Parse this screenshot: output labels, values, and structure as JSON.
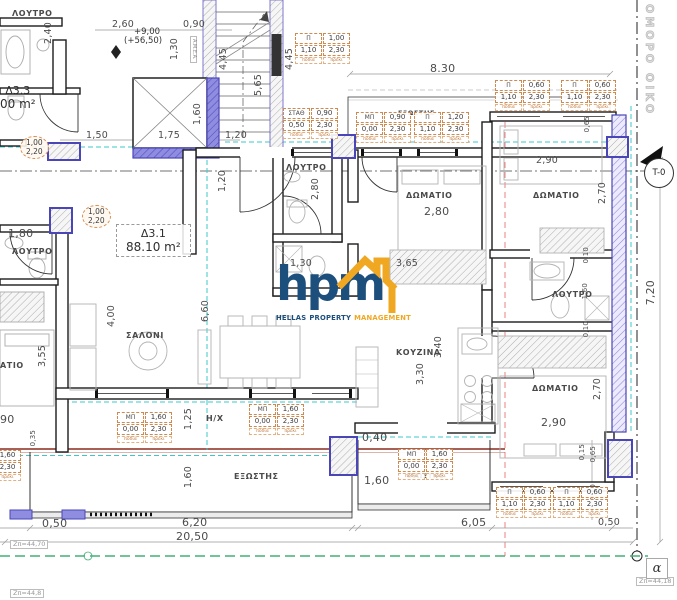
{
  "logo": {
    "word": "hpm",
    "tagline": [
      {
        "t": "HELLAS",
        "c": "navy"
      },
      {
        "t": "PROPERTY",
        "c": "navy"
      },
      {
        "t": "MANAGEMENT",
        "c": "orange"
      }
    ],
    "navy": "#1c4f7c",
    "orange": "#f0a722"
  },
  "apartments": [
    {
      "id": "Δ3.1",
      "area": "88.10 m²",
      "x": 116,
      "y": 224,
      "boxed": true
    },
    {
      "id": "Δ3.3",
      "area": "00 m²",
      "x": 0,
      "y": 84,
      "boxed": false
    }
  ],
  "rooms": [
    {
      "t": "ΛΟΥΤΡΟ",
      "x": 12,
      "y": 10
    },
    {
      "t": "ΛΟΥΤΡΟ",
      "x": 12,
      "y": 248
    },
    {
      "t": "ΑΤΙΟ",
      "x": 0,
      "y": 362
    },
    {
      "t": "ΣΑΛΟΝΙ",
      "x": 126,
      "y": 332
    },
    {
      "t": "ΛΟΥΤΡΟ",
      "x": 286,
      "y": 164
    },
    {
      "t": "ΔΩΜΑΤΙΟ",
      "x": 406,
      "y": 192
    },
    {
      "t": "ΚΟΥΖΙΝΑ",
      "x": 396,
      "y": 349
    },
    {
      "t": "ΔΩΜΑΤΙΟ",
      "x": 533,
      "y": 192
    },
    {
      "t": "ΛΟΥΤΡΟ",
      "x": 552,
      "y": 291
    },
    {
      "t": "ΔΩΜΑΤΙΟ",
      "x": 532,
      "y": 385
    },
    {
      "t": "ΕΞΩΣΤΗΣ",
      "x": 398,
      "y": 110,
      "sm": 1
    },
    {
      "t": "ΕΞΩΣΤΗΣ",
      "x": 234,
      "y": 473
    },
    {
      "t": "ΕΞΩΣΤΗΣ",
      "x": 407,
      "y": 473,
      "sm": 1
    },
    {
      "t": "Η/Χ",
      "x": 206,
      "y": 415
    }
  ],
  "dims": [
    {
      "t": "2,60",
      "x": 112,
      "y": 20
    },
    {
      "t": "0,90",
      "x": 183,
      "y": 20
    },
    {
      "t": "1,30",
      "x": 170,
      "y": 38,
      "v": 1
    },
    {
      "t": "2,40",
      "x": 44,
      "y": 22,
      "v": 1
    },
    {
      "t": "4,45",
      "x": 219,
      "y": 48,
      "v": 1
    },
    {
      "t": "4,45",
      "x": 285,
      "y": 48,
      "v": 1
    },
    {
      "t": "5,65",
      "x": 254,
      "y": 74,
      "v": 1
    },
    {
      "t": "1,60",
      "x": 193,
      "y": 103,
      "v": 1
    },
    {
      "t": "1,50",
      "x": 86,
      "y": 131
    },
    {
      "t": "1,75",
      "x": 158,
      "y": 131
    },
    {
      "t": "1,20",
      "x": 225,
      "y": 131
    },
    {
      "t": "8.30",
      "x": 430,
      "y": 63,
      "bg": 1
    },
    {
      "t": "0,65",
      "x": 584,
      "y": 116,
      "v": 1,
      "sm": 1
    },
    {
      "t": "2,90",
      "x": 536,
      "y": 156
    },
    {
      "t": "2,70",
      "x": 598,
      "y": 182,
      "v": 1
    },
    {
      "t": "7,20",
      "x": 645,
      "y": 280,
      "v": 1,
      "bg": 1
    },
    {
      "t": "2,80",
      "x": 311,
      "y": 178,
      "v": 1
    },
    {
      "t": "2,80",
      "x": 424,
      "y": 206,
      "bg": 1
    },
    {
      "t": "1,30",
      "x": 290,
      "y": 259
    },
    {
      "t": "3,65",
      "x": 396,
      "y": 259
    },
    {
      "t": "1,80",
      "x": 8,
      "y": 228,
      "bg": 1
    },
    {
      "t": "1,20",
      "x": 218,
      "y": 170,
      "v": 1
    },
    {
      "t": "4,00",
      "x": 107,
      "y": 305,
      "v": 1
    },
    {
      "t": "6,60",
      "x": 201,
      "y": 300,
      "v": 1
    },
    {
      "t": "3,55",
      "x": 38,
      "y": 345,
      "v": 1
    },
    {
      "t": "3,40",
      "x": 434,
      "y": 336,
      "v": 1
    },
    {
      "t": "3,30",
      "x": 416,
      "y": 363,
      "v": 1
    },
    {
      "t": "90",
      "x": 0,
      "y": 414,
      "bg": 1
    },
    {
      "t": "0,35",
      "x": 30,
      "y": 430,
      "v": 1,
      "sm": 1
    },
    {
      "t": "1,25",
      "x": 184,
      "y": 408,
      "v": 1
    },
    {
      "t": "1,60",
      "x": 184,
      "y": 466,
      "v": 1
    },
    {
      "t": "1,60",
      "x": 582,
      "y": 283,
      "v": 1,
      "sm": 1
    },
    {
      "t": "0,10",
      "x": 583,
      "y": 247,
      "v": 1,
      "sm": 1
    },
    {
      "t": "0,10",
      "x": 583,
      "y": 321,
      "v": 1,
      "sm": 1
    },
    {
      "t": "2,70",
      "x": 593,
      "y": 378,
      "v": 1
    },
    {
      "t": "2,90",
      "x": 541,
      "y": 417,
      "bg": 1
    },
    {
      "t": "0,40",
      "x": 362,
      "y": 432,
      "bg": 1
    },
    {
      "t": "1,60",
      "x": 364,
      "y": 475,
      "bg": 1
    },
    {
      "t": "0,15",
      "x": 579,
      "y": 444,
      "v": 1,
      "sm": 1
    },
    {
      "t": "0,65",
      "x": 590,
      "y": 446,
      "v": 1,
      "sm": 1
    },
    {
      "t": "0,70",
      "x": 590,
      "y": 484,
      "v": 1,
      "sm": 1
    },
    {
      "t": "0,50",
      "x": 598,
      "y": 518
    },
    {
      "t": "6,05",
      "x": 461,
      "y": 517,
      "bg": 1
    },
    {
      "t": "0,50",
      "x": 42,
      "y": 518,
      "bg": 1
    },
    {
      "t": "6,20",
      "x": 182,
      "y": 517,
      "bg": 1
    },
    {
      "t": "20,50",
      "x": 176,
      "y": 531,
      "bg": 1
    }
  ],
  "tags": [
    {
      "type": "window",
      "l": "Π",
      "w": "1,00",
      "s": "1,10",
      "h": "2,30",
      "x": 295,
      "y": 33
    },
    {
      "type": "window",
      "l": "ΣΤΑΘ",
      "w": "0,90",
      "s": "0,50",
      "h": "2,30",
      "x": 283,
      "y": 108
    },
    {
      "type": "window",
      "l": "ΜΠ",
      "w": "0,90",
      "s": "0,00",
      "h": "2,30",
      "x": 356,
      "y": 112
    },
    {
      "type": "window",
      "l": "Π",
      "w": "1,20",
      "s": "1,10",
      "h": "2,30",
      "x": 414,
      "y": 112
    },
    {
      "type": "window",
      "l": "Π",
      "w": "0,60",
      "s": "1,10",
      "h": "2,30",
      "x": 495,
      "y": 80
    },
    {
      "type": "window",
      "l": "Π",
      "w": "0,60",
      "s": "1,10",
      "h": "2,30",
      "x": 561,
      "y": 80
    },
    {
      "type": "door",
      "w": "1,00",
      "h": "2,20",
      "x": 82,
      "y": 205
    },
    {
      "type": "door",
      "w": "1,00",
      "h": "2,20",
      "x": 20,
      "y": 136
    },
    {
      "type": "window",
      "l": "ΜΠ",
      "w": "1,60",
      "s": "0,00",
      "h": "2,30",
      "x": 117,
      "y": 412
    },
    {
      "type": "window",
      "l": "ΜΠ",
      "w": "1,60",
      "s": "0,00",
      "h": "2,30",
      "x": 249,
      "y": 404
    },
    {
      "type": "window",
      "l": "ΜΠ",
      "w": "1,60",
      "s": "0,00",
      "h": "2,30",
      "x": 398,
      "y": 449
    },
    {
      "type": "window",
      "l": "Π",
      "w": "0,60",
      "s": "1,10",
      "h": "2,30",
      "x": 496,
      "y": 487
    },
    {
      "type": "window",
      "l": "Π",
      "w": "0,60",
      "s": "1,10",
      "h": "2,30",
      "x": 553,
      "y": 487
    },
    {
      "type": "window",
      "l": "ΜΠ",
      "w": "1,60",
      "s": "0,00",
      "h": "2,30",
      "x": -34,
      "y": 450
    }
  ],
  "tag_sub": [
    "ποδιά",
    "πρέκι"
  ],
  "notes": [
    {
      "t": "+9,00",
      "x": 134,
      "y": 28,
      "cls": "note"
    },
    {
      "t": "(+56,50)",
      "x": 124,
      "y": 37,
      "cls": "note"
    },
    {
      "t": "A.M.E.A.",
      "x": 190,
      "y": 36,
      "cls": "amea"
    },
    {
      "t": "ΟΜΟΡΟ ΟΙΚΟ",
      "x": 644,
      "y": 4,
      "cls": "site"
    },
    {
      "t": "Zπ=44,70",
      "x": 10,
      "y": 540,
      "cls": "zbox"
    },
    {
      "t": "Zπ=44,18",
      "x": 636,
      "y": 577,
      "cls": "zbox"
    },
    {
      "t": "Zπ=44,8",
      "x": 10,
      "y": 589,
      "cls": "zbox"
    }
  ],
  "markers": {
    "grid": "T-0",
    "alpha": "α"
  }
}
